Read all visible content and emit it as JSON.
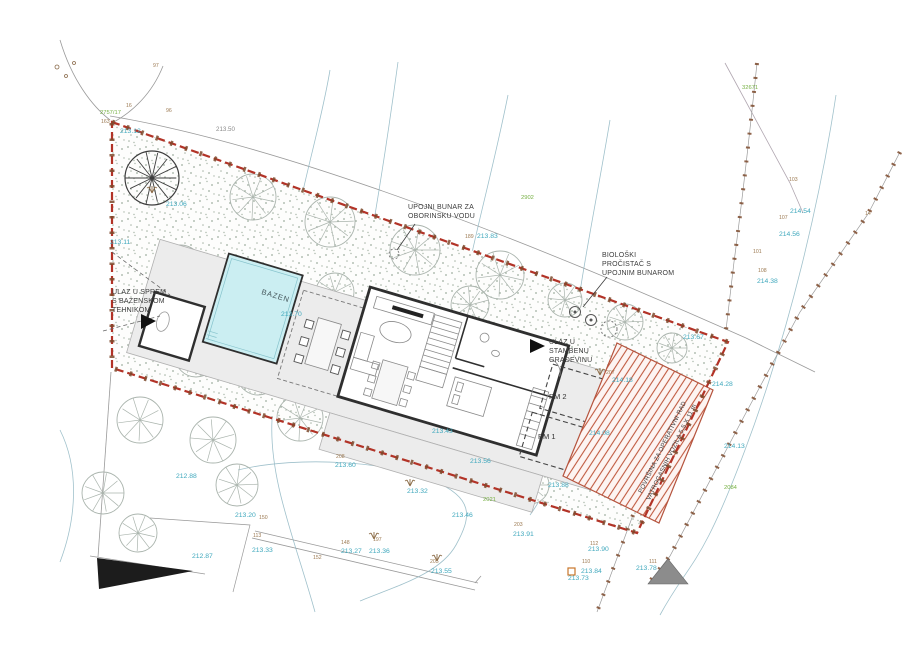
{
  "annotations": {
    "rain_well": {
      "lines": [
        "UPOJNI BUNAR ZA",
        "OBORINSKU VODU"
      ]
    },
    "bio_purifier": {
      "lines": [
        "BIOLOŠKI",
        "PROČISTAČ S",
        "UPOJNIM BUNAROM"
      ]
    },
    "pool_entrance": {
      "lines": [
        "ULAZ U SPREM",
        "S BAZENSKOM",
        "TEHNIKOM"
      ]
    },
    "house_entrance": {
      "lines": [
        "ULAZ U",
        "STAMBENU",
        "GRAĐEVINU"
      ]
    },
    "fire_area": {
      "lines": [
        "POVRŠINA ZA OPERATIVNI RAD",
        "VATROGASNIH VOZILA 5,5 X 11 m"
      ]
    },
    "pool_label": "BAZEN",
    "parking_1": "PM 1",
    "parking_2": "PM 2"
  },
  "elevation_labels": [
    {
      "text": "213.12",
      "x": 120,
      "y": 133
    },
    {
      "text": "213.06",
      "x": 166,
      "y": 206
    },
    {
      "text": "213.11",
      "x": 110,
      "y": 244
    },
    {
      "text": "213.83",
      "x": 477,
      "y": 238
    },
    {
      "text": "213.70",
      "x": 281,
      "y": 316
    },
    {
      "text": "213.67",
      "x": 683,
      "y": 339
    },
    {
      "text": "214.28",
      "x": 712,
      "y": 386
    },
    {
      "text": "214.13",
      "x": 724,
      "y": 448
    },
    {
      "text": "214.18",
      "x": 612,
      "y": 382
    },
    {
      "text": "214.08",
      "x": 589,
      "y": 435
    },
    {
      "text": "214.54",
      "x": 790,
      "y": 213
    },
    {
      "text": "214.56",
      "x": 779,
      "y": 236
    },
    {
      "text": "214.38",
      "x": 757,
      "y": 283
    },
    {
      "text": "213.43",
      "x": 432,
      "y": 433
    },
    {
      "text": "213.56",
      "x": 470,
      "y": 463
    },
    {
      "text": "213.60",
      "x": 335,
      "y": 467
    },
    {
      "text": "213.32",
      "x": 407,
      "y": 493
    },
    {
      "text": "213.46",
      "x": 452,
      "y": 517
    },
    {
      "text": "213.91",
      "x": 513,
      "y": 536
    },
    {
      "text": "213.55",
      "x": 431,
      "y": 573
    },
    {
      "text": "213.20",
      "x": 235,
      "y": 517
    },
    {
      "text": "213.33",
      "x": 252,
      "y": 552
    },
    {
      "text": "212.87",
      "x": 192,
      "y": 558
    },
    {
      "text": "212.88",
      "x": 176,
      "y": 478
    },
    {
      "text": "213.27",
      "x": 341,
      "y": 553
    },
    {
      "text": "213.36",
      "x": 369,
      "y": 553
    },
    {
      "text": "213.88",
      "x": 548,
      "y": 487
    },
    {
      "text": "213.90",
      "x": 588,
      "y": 551
    },
    {
      "text": "213.84",
      "x": 581,
      "y": 573
    },
    {
      "text": "213.73",
      "x": 568,
      "y": 580
    },
    {
      "text": "213.78",
      "x": 636,
      "y": 570
    }
  ],
  "point_numbers": [
    {
      "text": "97",
      "x": 153,
      "y": 67
    },
    {
      "text": "16",
      "x": 126,
      "y": 107
    },
    {
      "text": "96",
      "x": 166,
      "y": 112
    },
    {
      "text": "163",
      "x": 101,
      "y": 123
    },
    {
      "text": "103",
      "x": 789,
      "y": 181
    },
    {
      "text": "107",
      "x": 779,
      "y": 219
    },
    {
      "text": "101",
      "x": 753,
      "y": 253
    },
    {
      "text": "108",
      "x": 758,
      "y": 272
    },
    {
      "text": "14",
      "x": 865,
      "y": 215
    },
    {
      "text": "189",
      "x": 465,
      "y": 238
    },
    {
      "text": "150",
      "x": 259,
      "y": 519
    },
    {
      "text": "113",
      "x": 253,
      "y": 537
    },
    {
      "text": "148",
      "x": 341,
      "y": 544
    },
    {
      "text": "152",
      "x": 313,
      "y": 559
    },
    {
      "text": "197",
      "x": 373,
      "y": 541
    },
    {
      "text": "205",
      "x": 430,
      "y": 563
    },
    {
      "text": "203",
      "x": 514,
      "y": 526
    },
    {
      "text": "208",
      "x": 336,
      "y": 458
    },
    {
      "text": "112",
      "x": 590,
      "y": 545
    },
    {
      "text": "110",
      "x": 582,
      "y": 563
    },
    {
      "text": "111",
      "x": 649,
      "y": 563
    },
    {
      "text": "207",
      "x": 606,
      "y": 374
    }
  ],
  "parcel_numbers": [
    {
      "text": "2757/17",
      "x": 100,
      "y": 114
    },
    {
      "text": "32671",
      "x": 742,
      "y": 89
    },
    {
      "text": "2902",
      "x": 521,
      "y": 199
    },
    {
      "text": "2021",
      "x": 483,
      "y": 501
    },
    {
      "text": "2084",
      "x": 724,
      "y": 489
    }
  ],
  "misc_labels": [
    {
      "text": "213.50",
      "x": 216,
      "y": 131
    }
  ],
  "colors": {
    "boundary_red": "#b23327",
    "fence_brown": "#7c4a2d",
    "pool_fill": "#cbeef2",
    "hatch_red": "#c05a40",
    "elevation_cyan": "#3fa8bd",
    "parcel_green": "#76b043",
    "point_brown": "#9c7a52",
    "deck_gray": "#ececec",
    "wall_dark": "#2f2f2f"
  }
}
